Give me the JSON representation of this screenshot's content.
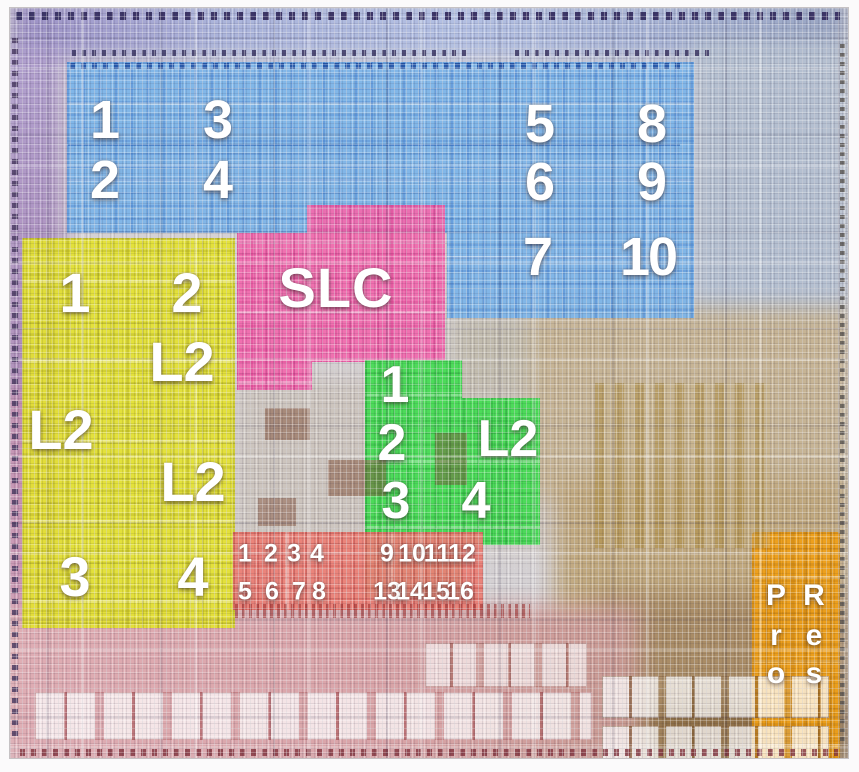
{
  "die": {
    "regions": {
      "gpu": {
        "color": "#7db5e9",
        "cores": [
          "1",
          "2",
          "3",
          "4",
          "5",
          "6",
          "7",
          "8",
          "9",
          "10"
        ]
      },
      "slc": {
        "color": "#f26bae",
        "label": "SLC"
      },
      "p_cores": {
        "color": "#e4e232",
        "cores": [
          "1",
          "2",
          "3",
          "4"
        ],
        "l2_labels": [
          "L2",
          "L2",
          "L2"
        ]
      },
      "e_cores": {
        "color": "#45dc53",
        "cores": [
          "1",
          "2",
          "3",
          "4"
        ],
        "l2_label": "L2"
      },
      "neural_engine": {
        "color": "#ec8076",
        "cores": [
          "1",
          "2",
          "3",
          "4",
          "5",
          "6",
          "7",
          "8",
          "9",
          "10",
          "11",
          "12",
          "13",
          "14",
          "15",
          "16"
        ]
      },
      "media_engine": {
        "color": "#f0a017",
        "label": "ProRes",
        "letter_columns": [
          [
            "P",
            "r",
            "o"
          ],
          [
            "R",
            "e",
            "s"
          ]
        ]
      }
    }
  }
}
